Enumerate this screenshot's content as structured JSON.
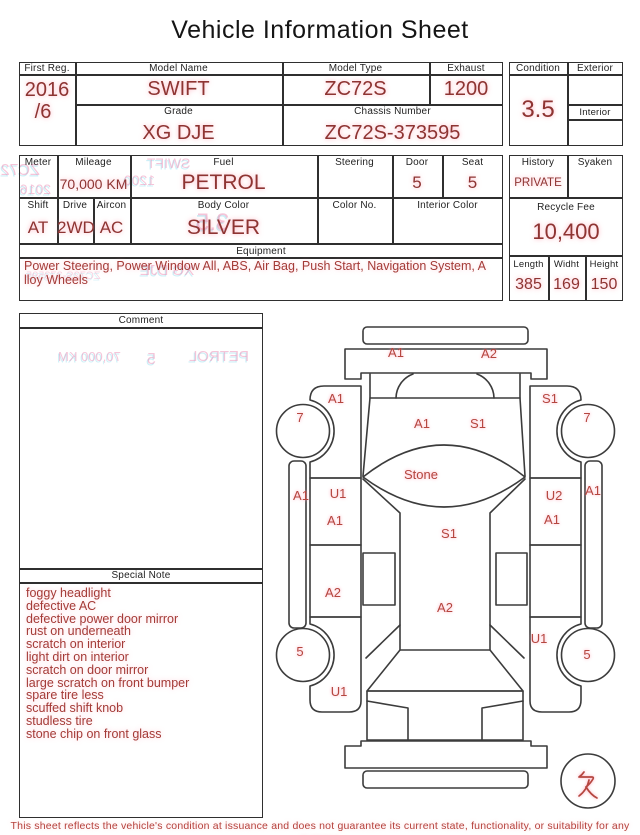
{
  "title": "Vehicle Information Sheet",
  "colors": {
    "value_red": "#8e3432",
    "note_red": "#a43b37",
    "diagram_label_red": "#b5463f",
    "border_black": "#2f2f2f"
  },
  "table1": {
    "headers": {
      "first_reg": "First Reg.",
      "model_name": "Model Name",
      "model_type": "Model Type",
      "exhaust": "Exhaust",
      "grade": "Grade",
      "chassis_number": "Chassis Number",
      "condition": "Condition",
      "exterior": "Exterior",
      "interior": "Interior"
    },
    "values": {
      "first_reg_year": "2016",
      "first_reg_month": "/6",
      "model_name": "SWIFT",
      "model_type": "ZC72S",
      "exhaust": "1200",
      "grade": "XG DJE",
      "chassis_number": "ZC72S-373595",
      "condition": "3.5",
      "exterior": "",
      "interior": ""
    }
  },
  "table2": {
    "headers": {
      "meter": "Meter",
      "mileage": "Mileage",
      "fuel": "Fuel",
      "steering": "Steering",
      "door": "Door",
      "seat": "Seat",
      "shift": "Shift",
      "drive": "Drive",
      "aircon": "Aircon",
      "body_color": "Body Color",
      "color_no": "Color No.",
      "interior_color": "Interior Color",
      "equipment": "Equipment",
      "history": "History",
      "syaken": "Syaken",
      "recycle_fee": "Recycle Fee",
      "length": "Length",
      "width": "Widht",
      "height": "Height"
    },
    "values": {
      "meter": "",
      "mileage": "70,000 KM",
      "fuel": "PETROL",
      "steering": "",
      "door": "5",
      "seat": "5",
      "shift": "AT",
      "drive": "2WD",
      "aircon": "AC",
      "body_color": "SILVER",
      "color_no": "",
      "interior_color": "",
      "equipment": "Power Steering, Power Window  All, ABS, Air Bag, Push Start, Navigation System, Alloy Wheels",
      "history": "PRIVATE",
      "syaken": "",
      "recycle_fee": "10,400",
      "length": "385",
      "width": "169",
      "height": "150"
    }
  },
  "comment": {
    "header": "Comment",
    "text": ""
  },
  "special_note": {
    "header": "Special Note",
    "lines": [
      "foggy headlight",
      "defective AC",
      "defective power door mirror",
      "rust on underneath",
      "scratch on interior",
      "light dirt on interior",
      "scratch on door mirror",
      "large scratch on front bumper",
      "spare tire less",
      "scuffed shift knob",
      "studless tire",
      "stone chip on front glass"
    ]
  },
  "diagram": {
    "marks": {
      "front_bumper_l": "A1",
      "front_bumper_r": "A2",
      "front_fender_l": "A1",
      "front_fender_r": "S1",
      "front_wheel_l": "7",
      "front_wheel_r": "7",
      "hood_l": "A1",
      "hood_r": "S1",
      "windshield": "Stone",
      "sill_l": "A1",
      "sill_r": "A1",
      "front_door_l_top": "U1",
      "front_door_l": "A1",
      "front_door_r_top": "U2",
      "front_door_r": "A1",
      "roof": "S1",
      "rear_door_l": "A2",
      "rear_body": "A2",
      "rear_quarter_r": "U1",
      "rear_wheel_l": "5",
      "rear_wheel_r": "5",
      "rear_fender_l": "U1",
      "spare_tire": "欠"
    }
  },
  "ghost_print_through": {
    "model_type": "ZC72S",
    "first_reg_year": "2016",
    "model_name": "SWIFT",
    "exhaust": "1200",
    "condition": "3.5",
    "grade": "XG DJE",
    "chassis_number": "ZC72S-373595",
    "mileage": "70,000 KM",
    "door": "5",
    "fuel": "PETROL"
  },
  "footer": {
    "disclaimer": "This sheet reflects the vehicle's condition at issuance and does not guarantee its current state, functionality, or suitability for any purpose"
  }
}
